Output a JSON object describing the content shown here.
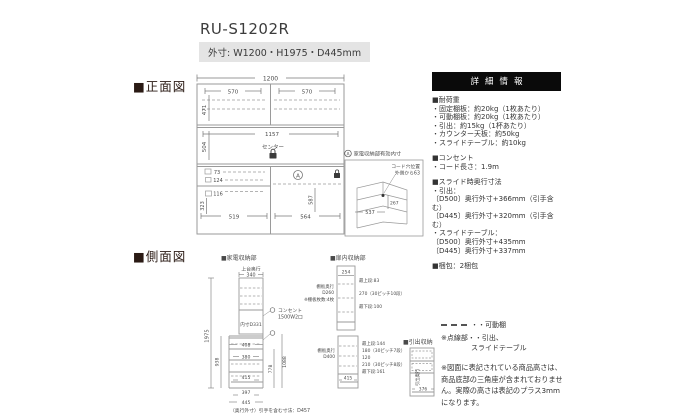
{
  "header": {
    "title": "RU-S1202R",
    "outer_dims": "外寸: W1200・H1975・D445mm"
  },
  "sections": {
    "front": "■正面図",
    "side": "■側面図"
  },
  "colors": {
    "badge_bg": "#e4e4e4",
    "info_header_bg": "#0a0a0a",
    "diagram_line": "#9a9a9a",
    "section_square": "#2a1a14"
  },
  "front_view": {
    "dim_total_width": "1200",
    "dim_upper_left": "570",
    "dim_upper_right": "570",
    "dim_upper_height": "471",
    "dim_mid_width": "1157",
    "dim_mid_height": "504",
    "center_label": "センター",
    "dim_73": "73",
    "dim_124": "124",
    "dim_116": "116",
    "dim_323": "323",
    "dim_519": "519",
    "dim_564": "564",
    "dim_587": "587",
    "a_mark": "A"
  },
  "note_box": {
    "a_mark": "A",
    "title": "家電収納部有効内寸",
    "cord_line1": "コード穴位置",
    "cord_line2": "外側から63",
    "dim_267": "267",
    "dim_537": "537"
  },
  "info_panel": {
    "header": "詳細情報",
    "load": {
      "title": "■耐荷重",
      "items": [
        "・固定棚板：約20kg（1枚あたり）",
        "・可動棚板：約20kg（1枚あたり）",
        "・引出：約15kg（1杯あたり）",
        "・カウンター天板：約50kg",
        "・スライドテーブル：約10kg"
      ]
    },
    "outlet": {
      "title": "■コンセント",
      "items": [
        "・コード長さ：1.9m"
      ]
    },
    "slide": {
      "title": "■スライド時奥行寸法",
      "items": [
        "・引出：",
        "〔D500〕奥行外寸+366mm（引手含む）",
        "〔D445〕奥行外寸+320mm（引手含む）",
        "・スライドテーブル：",
        "〔D500〕奥行外寸+435mm",
        "〔D445〕奥行外寸+337mm"
      ]
    },
    "packing": "■梱包：2梱包"
  },
  "side_view": {
    "label": "■家電収納部",
    "top_depth_label": "上台奥行",
    "dim_340": "340",
    "dim_1975": "1975",
    "inner_depth": "内寸D331",
    "outlet_line1": "コンセント",
    "outlet_line2": "1500W2口",
    "dim_408": "408",
    "dim_380": "380",
    "dim_938": "938",
    "dim_778": "778",
    "dim_1088": "1088",
    "dim_415": "415",
    "dim_397": "397",
    "dim_445": "445",
    "footnote": "（奥行外寸）引手を含む寸法：D457"
  },
  "door_storage": {
    "label": "■扉内収納部",
    "dim_254": "254",
    "top_shelf": "最上段:83",
    "pitch": "270（30ピッチ10段）",
    "bottom_shelf": "最下段:100",
    "shelf_depth_l1": "棚板奥行",
    "shelf_depth_l2": "D260",
    "shelf_count": "※棚板枚数:4枚",
    "lower": {
      "shelf_depth_l1": "棚板奥行",
      "shelf_depth_l2": "D400",
      "top_shelf": "最上段:144",
      "pitch1": "180（30ピッチ7段）",
      "mid": "120",
      "pitch2": "210（30ピッチ8段）",
      "bottom_shelf": "最下段:161",
      "dim_415": "415"
    }
  },
  "drawer_storage": {
    "label": "■引出収納",
    "depth_label": "引出奥行",
    "dim_376": "376"
  },
  "legend": {
    "movable": "・・可動棚",
    "dotted1": "※点線部・・引出、",
    "dotted2": "スライドテーブル",
    "note": "※図面に表記されている商品高さは、商品底部の三角座が含まれておりません。実際の高さは表記のプラス3mmになります。"
  }
}
